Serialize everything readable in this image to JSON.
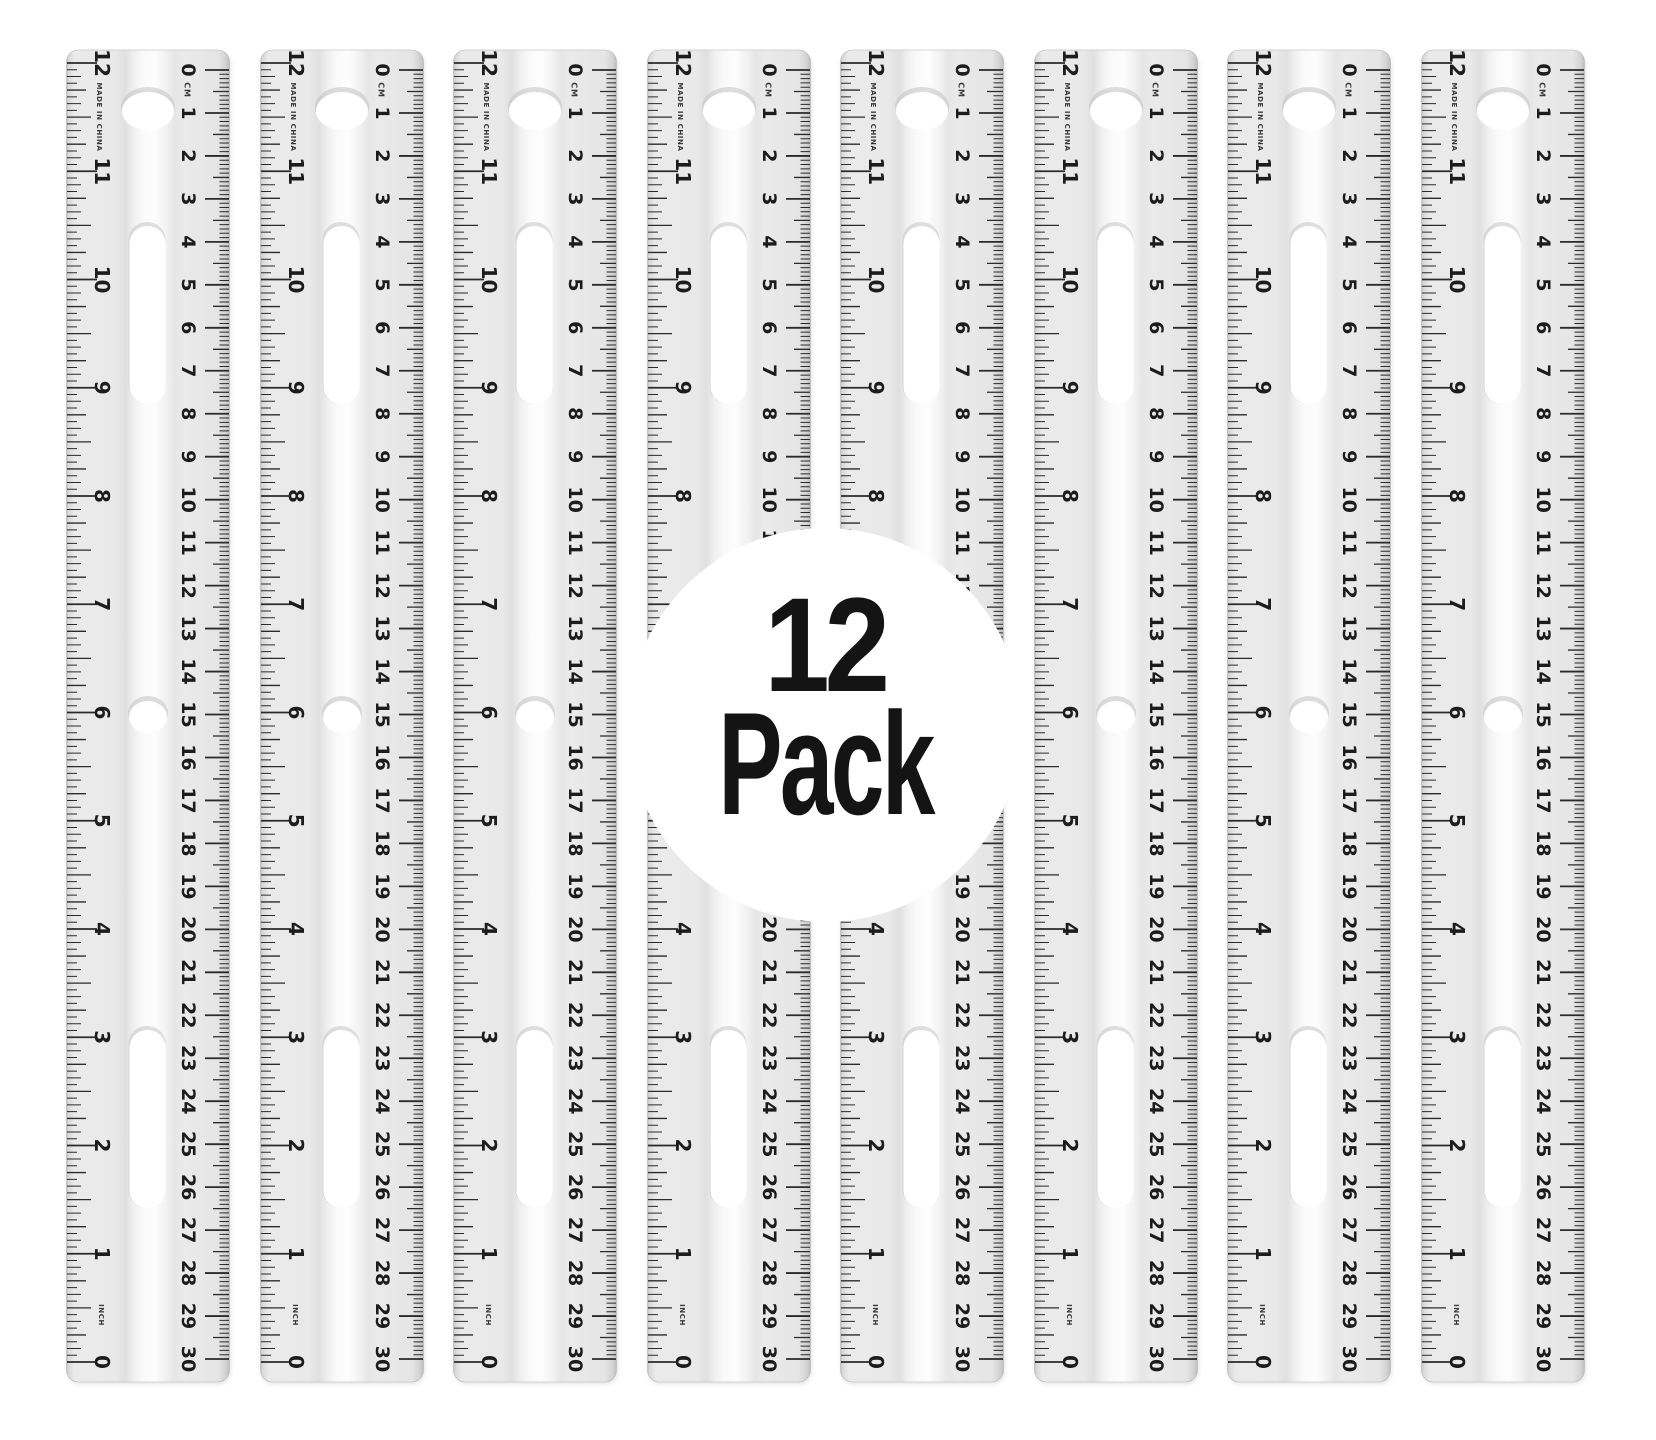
{
  "scene": {
    "description": "Product image: pack of clear plastic 12 inch / 30 cm rulers",
    "background": "#ffffff"
  },
  "badge": {
    "count": "12",
    "label": "Pack",
    "background": "#ffffff",
    "text_color": "#141414"
  },
  "rulers": {
    "visible_count": 8,
    "made_in_text": "MADE IN CHINA",
    "cm_unit_label": "CM",
    "inch_unit_label": "INCH",
    "inch_numbers": [
      "12",
      "11",
      "10",
      "9",
      "8",
      "7",
      "6",
      "5",
      "4",
      "3",
      "2",
      "1",
      "0"
    ],
    "cm_numbers": [
      "0",
      "1",
      "2",
      "3",
      "4",
      "5",
      "6",
      "7",
      "8",
      "9",
      "10",
      "11",
      "12",
      "13",
      "14",
      "15",
      "16",
      "17",
      "18",
      "19",
      "20",
      "21",
      "22",
      "23",
      "24",
      "25",
      "26",
      "27",
      "28",
      "29",
      "30"
    ],
    "inch_subdivisions_per_unit": 16,
    "mm_ticks_per_cm": 10,
    "body_color": "#ebebeb",
    "edge_color": "#bdbdbd",
    "highlight_color": "#fdfdfd",
    "ink_color": "#2a2a2a",
    "hole_color": "#ffffff"
  }
}
